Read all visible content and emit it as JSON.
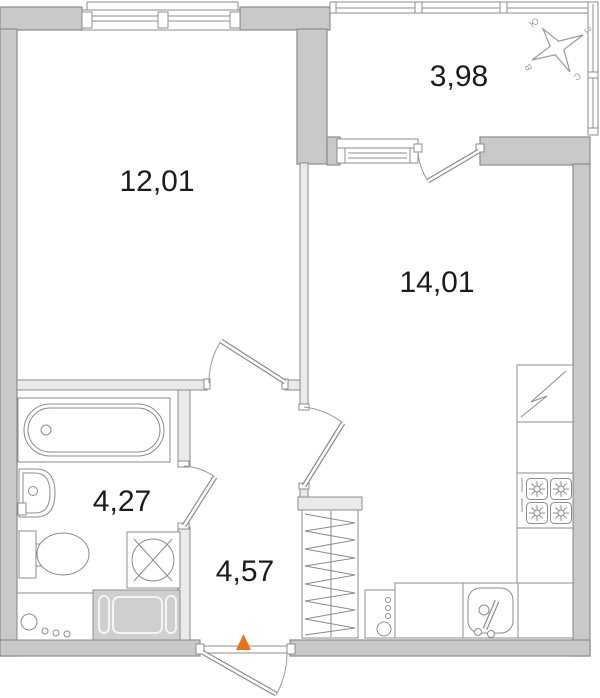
{
  "plan": {
    "type": "apartment-floor-plan",
    "rooms": [
      {
        "name": "living-room",
        "area_m2": "12,01"
      },
      {
        "name": "balcony",
        "area_m2": "3,98"
      },
      {
        "name": "kitchen-living",
        "area_m2": "14,01"
      },
      {
        "name": "bathroom",
        "area_m2": "4,27"
      },
      {
        "name": "hallway",
        "area_m2": "4,57"
      }
    ],
    "compass": {
      "labels": {
        "south": "Ю",
        "west": "З",
        "east": "В",
        "north": "С"
      }
    },
    "fixtures": [
      "window",
      "balcony-glazing",
      "bathtub",
      "washbasin",
      "toilet",
      "washing-machine",
      "vent-block",
      "wardrobe",
      "refrigerator",
      "stove-4-burner",
      "kitchen-counter",
      "kitchen-sink",
      "dishwasher",
      "interior-doors",
      "entrance-door",
      "entrance-marker",
      "compass-rose"
    ],
    "colors": {
      "wall-ext": "#c9c9c9",
      "wall-int": "#eaeaea",
      "line": "#8c8c8c",
      "text": "#1b1b1b",
      "accent": "#e8711c",
      "vent": "#cfcfcf",
      "compass": "#9a9a9a"
    }
  }
}
